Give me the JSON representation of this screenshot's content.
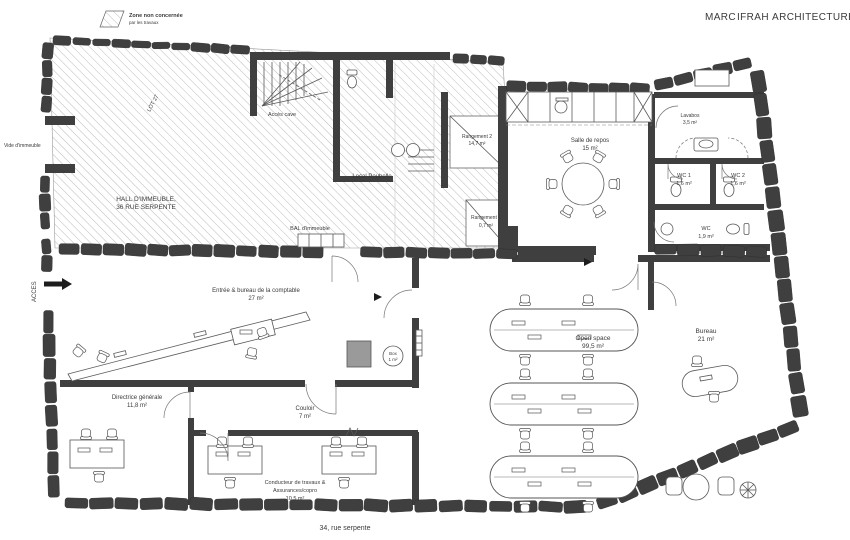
{
  "colors": {
    "wall": "#3f3f3f",
    "accent_red": "#b5383c",
    "hatch_line": "#b3b3b3",
    "drawing_line": "#555555",
    "text": "#3a3a3a"
  },
  "logo": {
    "marc": "MARC",
    "ifrah": "IFRAH",
    "architecture": "ARCHITECTURE"
  },
  "legend": {
    "line1": "Zone non concernée",
    "line2": "par les travaux"
  },
  "annotations": {
    "vide": "Vide d'immeuble",
    "acces": "ACCES",
    "lot": "LOT 27",
    "acces_cave": "Accès cave",
    "local_poubelle": "Local Poubelle",
    "hall_line1": "HALL D'IMMEUBLE,",
    "hall_line2": "36 RUE SERPENTE",
    "bal": "BAL d'immeuble",
    "street": "34, rue serpente"
  },
  "rooms": {
    "rangement2": {
      "name": "Rangement 2",
      "area": "14,7 m²"
    },
    "salle_de_repos": {
      "name": "Salle de repos",
      "area": "15 m²"
    },
    "lavabos": {
      "name": "Lavabos",
      "area": "3,5 m²"
    },
    "wc1": {
      "name": "WC 1",
      "area": "1,6 m²"
    },
    "wc2": {
      "name": "WC 2",
      "area": "1,6 m²"
    },
    "wc": {
      "name": "WC",
      "area": "1,9 m²"
    },
    "rangement1": {
      "name": "Rangement 1",
      "area": "0,7 m²"
    },
    "entree": {
      "name": "Entrée & bureau de la comptable",
      "area": "27 m²"
    },
    "box": {
      "name": "Box",
      "area": "1 m²"
    },
    "open_space": {
      "name": "Open space",
      "area": "99,5 m²"
    },
    "bureau": {
      "name": "Bureau",
      "area": "21 m²"
    },
    "directrice": {
      "name": "Directrice générale",
      "area": "11,8 m²"
    },
    "couloir": {
      "name": "Couloir",
      "area": "7 m²"
    },
    "conducteur": {
      "name": "Conducteur de travaux &",
      "name2": "Assurances/copro",
      "area": "10,5 m²"
    }
  }
}
